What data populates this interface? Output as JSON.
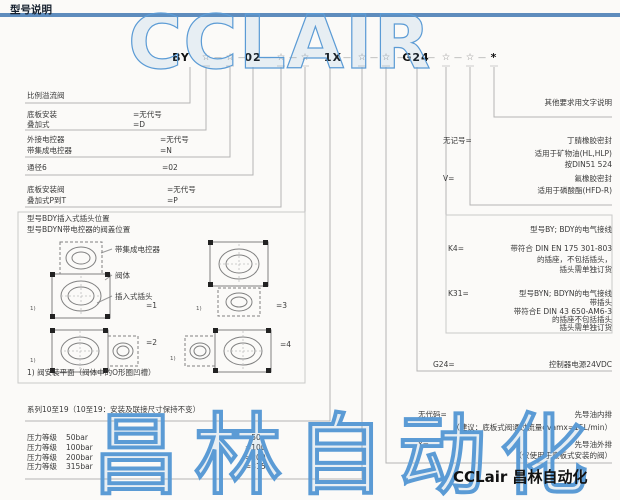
{
  "header": {
    "title": "型号说明"
  },
  "code": {
    "separator": "—",
    "tokens": [
      "BY",
      "☆",
      "☆",
      "02",
      "☆",
      "☆",
      "1X",
      "☆",
      "☆",
      "G24",
      "☆",
      "☆",
      "*"
    ]
  },
  "left": {
    "row1_label": "比例溢流阀",
    "row2": [
      {
        "label": "底板安装",
        "value": "=无代号"
      },
      {
        "label": "叠加式",
        "value": "=D"
      }
    ],
    "row3": [
      {
        "label": "外接电控器",
        "value": "=无代号"
      },
      {
        "label": "带集成电控器",
        "value": "=N"
      }
    ],
    "row4": [
      {
        "label": "通径6",
        "value": "=02"
      }
    ],
    "row5": [
      {
        "label": "底板安装阀",
        "value": "=无代号"
      },
      {
        "label": "叠加式P到T",
        "value": "=P"
      }
    ]
  },
  "diagram": {
    "title_line1": "型号BDY插入式插头位置",
    "title_line2": "型号BDYN带电控器的阀盖位置",
    "callout_controller": "带集成电控器",
    "callout_body": "阀体",
    "callout_plug": "插入式插头",
    "pos1": "=1",
    "pos2": "=2",
    "pos3": "=3",
    "pos4": "=4",
    "ref": "1)",
    "footnote": "1) 阀安装平面（阀体中的O形圈凹槽）"
  },
  "series": {
    "label": "系列10至19（10至19：安装及联接尺寸保持不变）"
  },
  "pressure": {
    "rows": [
      {
        "label": "压力等级",
        "spec": "50bar",
        "value": "=50"
      },
      {
        "label": "压力等级",
        "spec": "100bar",
        "value": "=100"
      },
      {
        "label": "压力等级",
        "spec": "200bar",
        "value": "=200"
      },
      {
        "label": "压力等级",
        "spec": "315bar",
        "value": "=315"
      }
    ]
  },
  "right": {
    "other_note": "其他要求用文字说明",
    "seal": {
      "key_none": "无记号=",
      "nbr": "丁腈橡胶密封",
      "nbr_use": "适用于矿物油(HL,HLP)",
      "nbr_std": "按DIN51 524",
      "key_v": "V=",
      "fkm": "氟橡胶密封",
      "fkm_use": "适用于磷酸酯(HFD-R)"
    },
    "electrical": {
      "title": "型号BY; BDY的电气接线",
      "key_k4": "K4=",
      "k4_line1": "带符合 DIN EN 175 301-803",
      "k4_line2": "的插座，不包括插头，",
      "k4_line3": "插头需单独订货",
      "key_k31": "K31=",
      "k31_line1": "型号BYN; BDYN的电气接线",
      "k31_line2": "带插头",
      "k31_line3": "带符合E DIN 43 650-AM6-3",
      "k31_line4": "的插座不包括插头",
      "k31_line5": "插头需单独订货"
    },
    "power": {
      "key": "G24=",
      "value": "控制器电源24VDC"
    },
    "pilot": {
      "key_none": "无代码=",
      "internal": "先导油内排",
      "internal_note": "（建议：底板式阀通过流量qvamx=15L/min）",
      "key_y": "Y=",
      "external": "先导油外排",
      "external_note": "（仅使用于底板式安装的阀）"
    }
  },
  "watermark": {
    "top": "CCLAIR",
    "bottom": "昌林自动化"
  },
  "footer": {
    "brand": "CCLair 昌林自动化"
  },
  "colors": {
    "accent_bar": "#5e8cbd",
    "watermark_blue": "#5b9bd5",
    "line_gray": "#b4b4b4"
  }
}
